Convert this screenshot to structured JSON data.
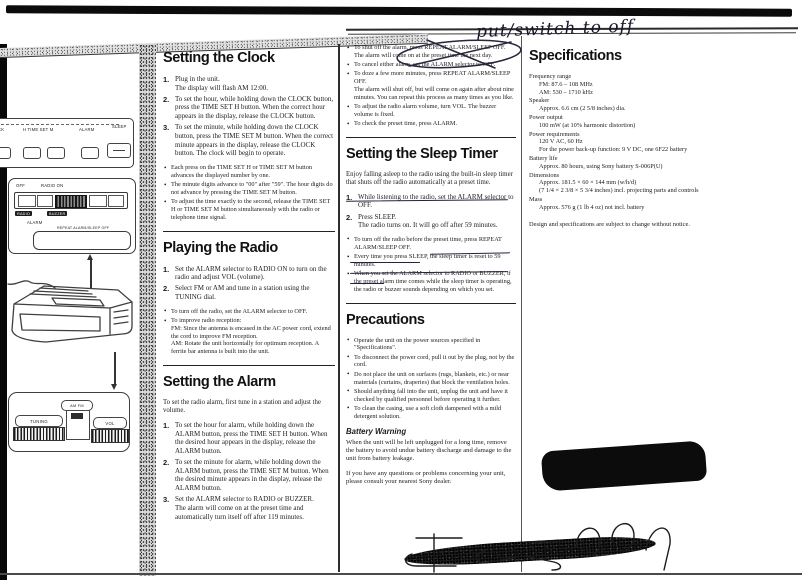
{
  "annotations": {
    "top_note": "put/switch to off"
  },
  "device": {
    "top_labels": {
      "clock": "CK",
      "timeset": "H TIME SET M",
      "alarm": "ALARM",
      "sleep": "SLEEP"
    },
    "panel": {
      "off": "OFF",
      "radio_on": "RADIO ON",
      "radio": "RADIO",
      "buzzer": "BUZZER",
      "alarm": "ALARM",
      "repeat": "REPEAT ALARM/SLEEP OFF"
    },
    "bottom": {
      "tuning": "TUNING",
      "band": "AM FM",
      "vol": "VOL"
    }
  },
  "clock": {
    "title": "Setting the Clock",
    "steps": [
      "Plug in the unit.\nThe display will flash AM 12:00.",
      "To set the hour, while holding down the CLOCK button, press the TIME SET H button.  When the correct hour appears in the display, release the CLOCK button.",
      "To set the minute, while holding down the CLOCK button, press the TIME SET M button. When the correct minute appears in the display, release the CLOCK button.  The clock will begin to operate."
    ],
    "notes": [
      "Each press on the TIME SET H or TIME SET M button advances the displayed number by one.",
      "The minute digits advance to \"00\" after \"59\".  The hour digits do not advance by pressing the TIME SET M button.",
      "To adjust the time exactly to the second, release the TIME SET H or TIME SET M button simultaneously with the radio or telephone time signal."
    ]
  },
  "radio": {
    "title": "Playing the Radio",
    "steps": [
      "Set the ALARM selector to RADIO ON to turn on the radio and adjust VOL (volume).",
      "Select FM or AM and tune in a station using the TUNING dial."
    ],
    "notes": [
      "To turn off the radio, set the ALARM selector to OFF.",
      "To improve radio reception:\nFM:   Since the antenna is encased in the AC power cord, extend the cord to improve FM reception.\nAM:   Rotate the unit horizontally for optimum reception.  A ferrite bar antenna is built into the unit."
    ]
  },
  "alarm": {
    "title": "Setting the Alarm",
    "intro": "To set the radio alarm, first tune in a station and adjust the volume.",
    "steps": [
      "To set the hour for alarm, while holding down the ALARM button, press the TIME SET H button. When the desired hour appears in the display, release the ALARM button.",
      "To set the minute for alarm, while holding down the ALARM button, press the TIME SET M button.  When the desired minute appears in the display, release the ALARM button.",
      "Set the ALARM selector to RADIO or BUZZER.\nThe alarm will come on at the preset time and automatically turn itself off after 119 minutes."
    ]
  },
  "alarm_notes": [
    "To shut off the alarm, press REPEAT ALARM/SLEEP OFF.\nThe alarm will come on at the preset time the next day.",
    "To cancel either alarm, set the ALARM selector to OFF.",
    "To doze a few more minutes, press REPEAT ALARM/SLEEP OFF.\nThe alarm will shut off, but will come on again after about nine minutes.  You can repeat this process as many times as you like.",
    "To adjust the radio alarm volume, turn VOL.  The buzzer volume is fixed.",
    "To check the preset time, press ALARM."
  ],
  "sleep": {
    "title": "Setting the Sleep Timer",
    "intro": "Enjoy falling asleep to the radio using the built-in sleep timer that shuts off the radio automatically at a preset time.",
    "steps": [
      "While listening to the radio, set the ALARM selector to OFF.",
      "Press SLEEP.\nThe radio turns on.  It will go off after 59 minutes."
    ],
    "notes": [
      "To turn off the radio before the preset time, press REPEAT ALARM/SLEEP OFF.",
      "Every time you press SLEEP, the sleep timer is reset to 59 minutes.",
      "When you set the ALARM selector to RADIO or BUZZER, if the preset alarm time comes while the sleep timer is operating, the radio or buzzer sounds depending on which you set."
    ]
  },
  "precautions": {
    "title": "Precautions",
    "items": [
      "Operate the unit on the power sources specified in \"Specifications\".",
      "To disconnect the power cord, pull it out by the plug, not by the cord.",
      "Do not place the unit on surfaces (rugs, blankets, etc.) or near materials (curtains, draperies) that block the ventilation holes.",
      "Should anything fall into the unit, unplug the unit and have it checked by qualified personnel before operating it further.",
      "To clean the casing, use a soft cloth dampened with a mild detergent solution."
    ],
    "battery_title": "Battery Warning",
    "battery_text": "When the unit will be left unplugged for a long time, remove the battery to avoid undue battery discharge and damage to the unit from battery leakage.",
    "closing": "If you have any questions or problems concerning your unit, please consult your nearest Sony dealer."
  },
  "specs": {
    "title": "Specifications",
    "entries": [
      {
        "label": "Frequency range",
        "value": "FM:  87.6 – 108 MHz\nAM:  530 – 1710 kHz"
      },
      {
        "label": "Speaker",
        "value": "Approx. 6.6 cm (2 5/8 inches) dia."
      },
      {
        "label": "Power output",
        "value": "100 mW (at 10% harmonic distortion)"
      },
      {
        "label": "Power requirements",
        "value": "120 V AC, 60 Hz\nFor the power back-up function: 9 V DC, one 6F22 battery"
      },
      {
        "label": "Battery life",
        "value": "Approx. 80 hours, using Sony battery S-006P(U)"
      },
      {
        "label": "Dimensions",
        "value": "Approx. 181.5 × 60 × 144 mm (w/h/d)\n(7 1/4 × 2 3/8 × 5 3/4 inches) incl. projecting parts and controls"
      },
      {
        "label": "Mass",
        "value": "Approx. 576 g (1 lb 4 oz) not incl. battery"
      }
    ],
    "footnote": "Design and specifications are subject to change without notice."
  }
}
